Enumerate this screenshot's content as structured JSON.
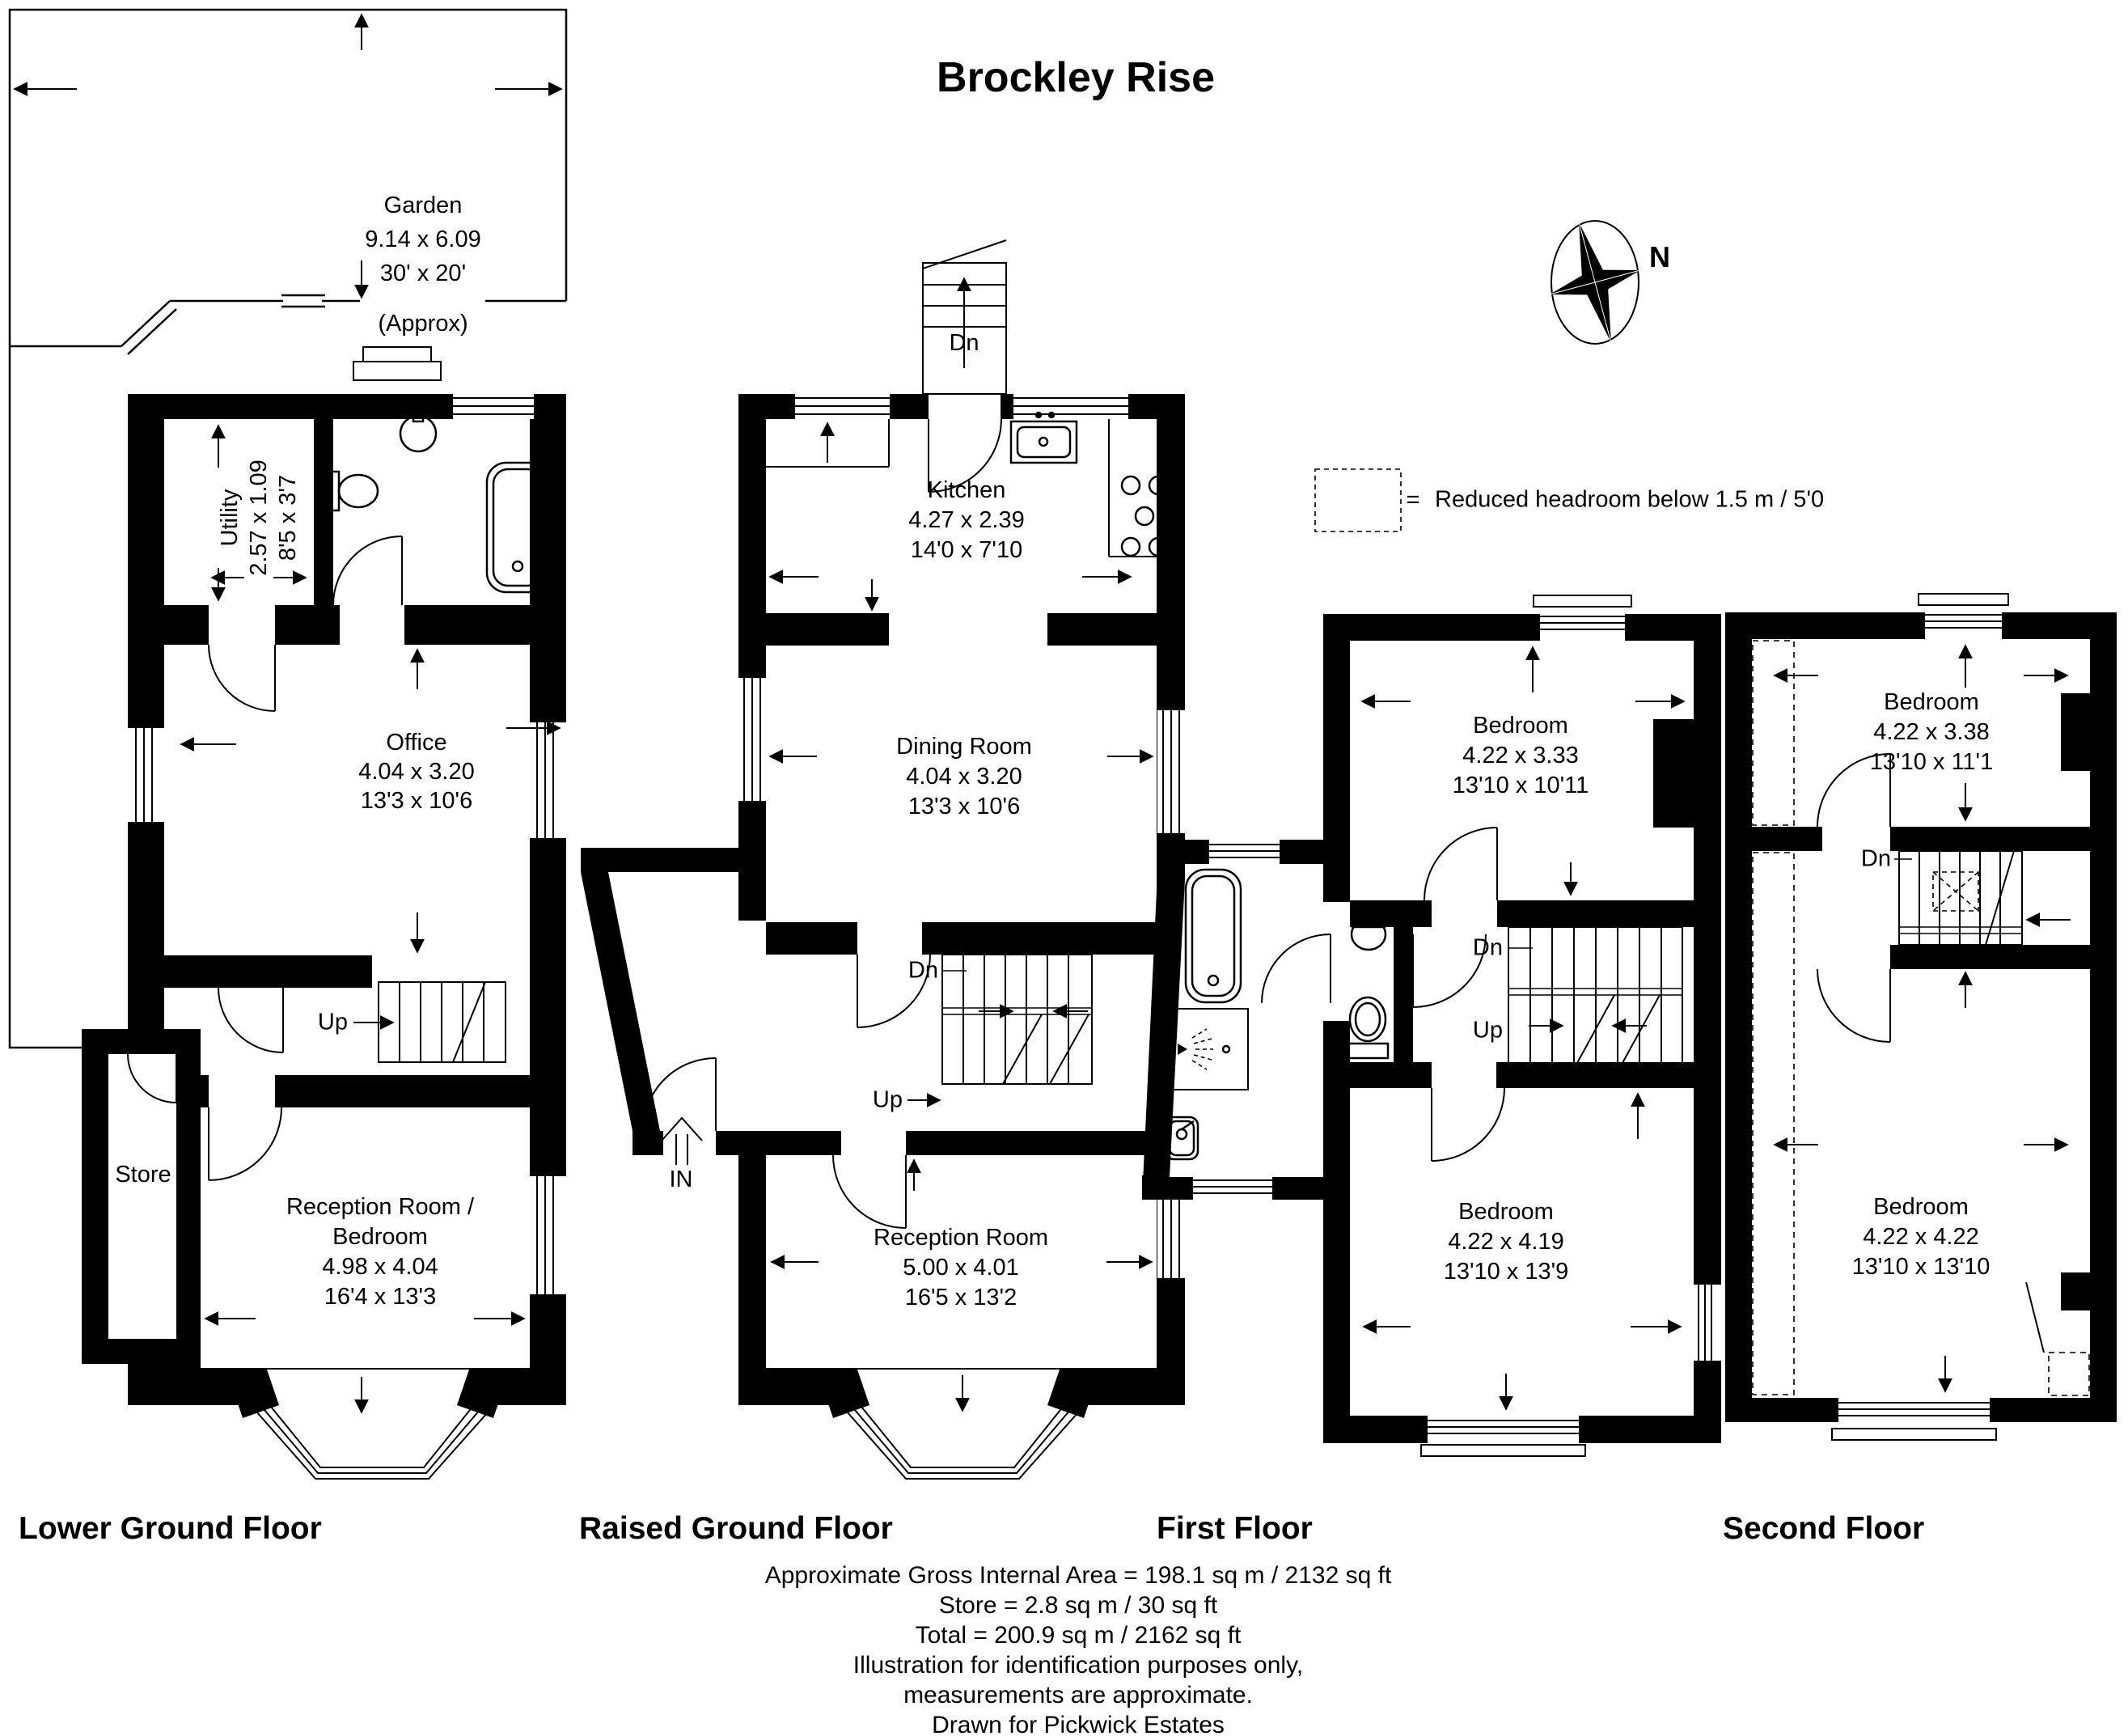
{
  "title": "Brockley Rise",
  "compass": {
    "north": "N"
  },
  "legend": {
    "eq": "=",
    "text": "Reduced headroom below 1.5 m / 5'0"
  },
  "garden": {
    "name": "Garden",
    "metric": "9.14 x 6.09",
    "imperial": "30' x 20'",
    "note": "(Approx)"
  },
  "floors": {
    "lower": {
      "label": "Lower Ground Floor",
      "rooms": {
        "utility": {
          "name": "Utility",
          "metric": "2.57 x 1.09",
          "imperial": "8'5 x 3'7"
        },
        "office": {
          "name": "Office",
          "metric": "4.04 x 3.20",
          "imperial": "13'3 x 10'6"
        },
        "store": {
          "name": "Store"
        },
        "reception": {
          "line1": "Reception Room /",
          "line2": "Bedroom",
          "metric": "4.98 x 4.04",
          "imperial": "16'4 x 13'3"
        }
      },
      "stairs": {
        "up": "Up"
      }
    },
    "raised": {
      "label": "Raised Ground Floor",
      "entrance": "IN",
      "rooms": {
        "kitchen": {
          "name": "Kitchen",
          "metric": "4.27 x 2.39",
          "imperial": "14'0 x 7'10"
        },
        "dining": {
          "name": "Dining Room",
          "metric": "4.04 x 3.20",
          "imperial": "13'3 x 10'6"
        },
        "reception": {
          "name": "Reception Room",
          "metric": "5.00 x 4.01",
          "imperial": "16'5 x 13'2"
        }
      },
      "stairs": {
        "dn_external": "Dn",
        "dn": "Dn",
        "up": "Up"
      }
    },
    "first": {
      "label": "First Floor",
      "rooms": {
        "bedroom1": {
          "name": "Bedroom",
          "metric": "4.22 x 3.33",
          "imperial": "13'10 x 10'11"
        },
        "bedroom2": {
          "name": "Bedroom",
          "metric": "4.22 x 4.19",
          "imperial": "13'10 x 13'9"
        }
      },
      "stairs": {
        "dn": "Dn",
        "up": "Up"
      }
    },
    "second": {
      "label": "Second Floor",
      "rooms": {
        "bedroom1": {
          "name": "Bedroom",
          "metric": "4.22 x 3.38",
          "imperial": "13'10 x 11'1"
        },
        "bedroom2": {
          "name": "Bedroom",
          "metric": "4.22 x 4.22",
          "imperial": "13'10 x 13'10"
        }
      },
      "stairs": {
        "dn": "Dn"
      }
    }
  },
  "footer": {
    "lines": [
      "Approximate Gross Internal Area = 198.1 sq m / 2132 sq ft",
      "Store = 2.8 sq m / 30 sq ft",
      "Total = 200.9 sq m / 2162 sq ft",
      "Illustration for identification purposes only,",
      "measurements are approximate.",
      "Drawn for Pickwick Estates"
    ]
  }
}
